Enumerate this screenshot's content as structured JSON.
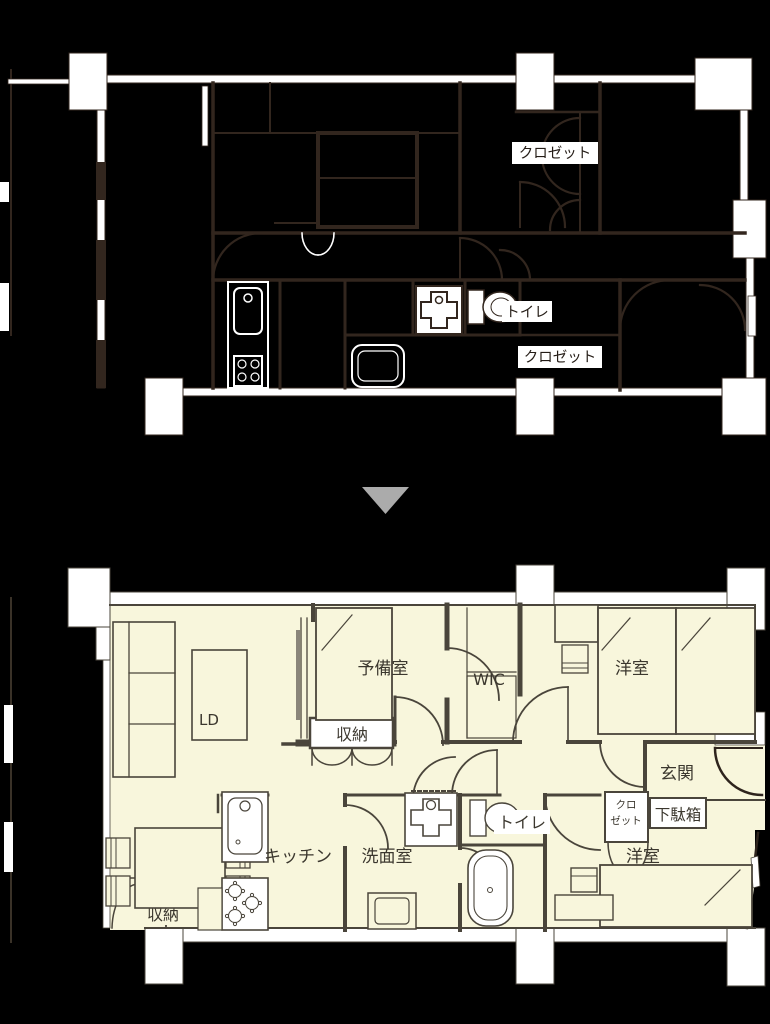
{
  "plans": {
    "before": {
      "labels": {
        "closet_top": "クロゼット",
        "toilet": "トイレ",
        "closet_bottom": "クロゼット"
      }
    },
    "after": {
      "labels": {
        "spare_room": "予備室",
        "wic": "WIC",
        "bedroom_right": "洋室",
        "living_dining": "LD",
        "storage_center": "収納",
        "entrance": "玄関",
        "closet_line1": "クロ",
        "closet_line2": "ゼット",
        "shoe_cabinet": "下駄箱",
        "toilet": "トイレ",
        "kitchen": "キッチン",
        "washroom": "洗面室",
        "storage_left": "収納",
        "bedroom_bottom": "洋室"
      }
    }
  },
  "arrow": {
    "direction": "down",
    "color": "#ABABAB"
  },
  "colors": {
    "background": "#000000",
    "before_line": "#32261E",
    "before_fill": "#FFFFFF",
    "after_line": "#4A453B",
    "after_room_fill": "#F8F6DC",
    "label_text_before": "#241C16",
    "label_text_after": "#3B372E"
  }
}
